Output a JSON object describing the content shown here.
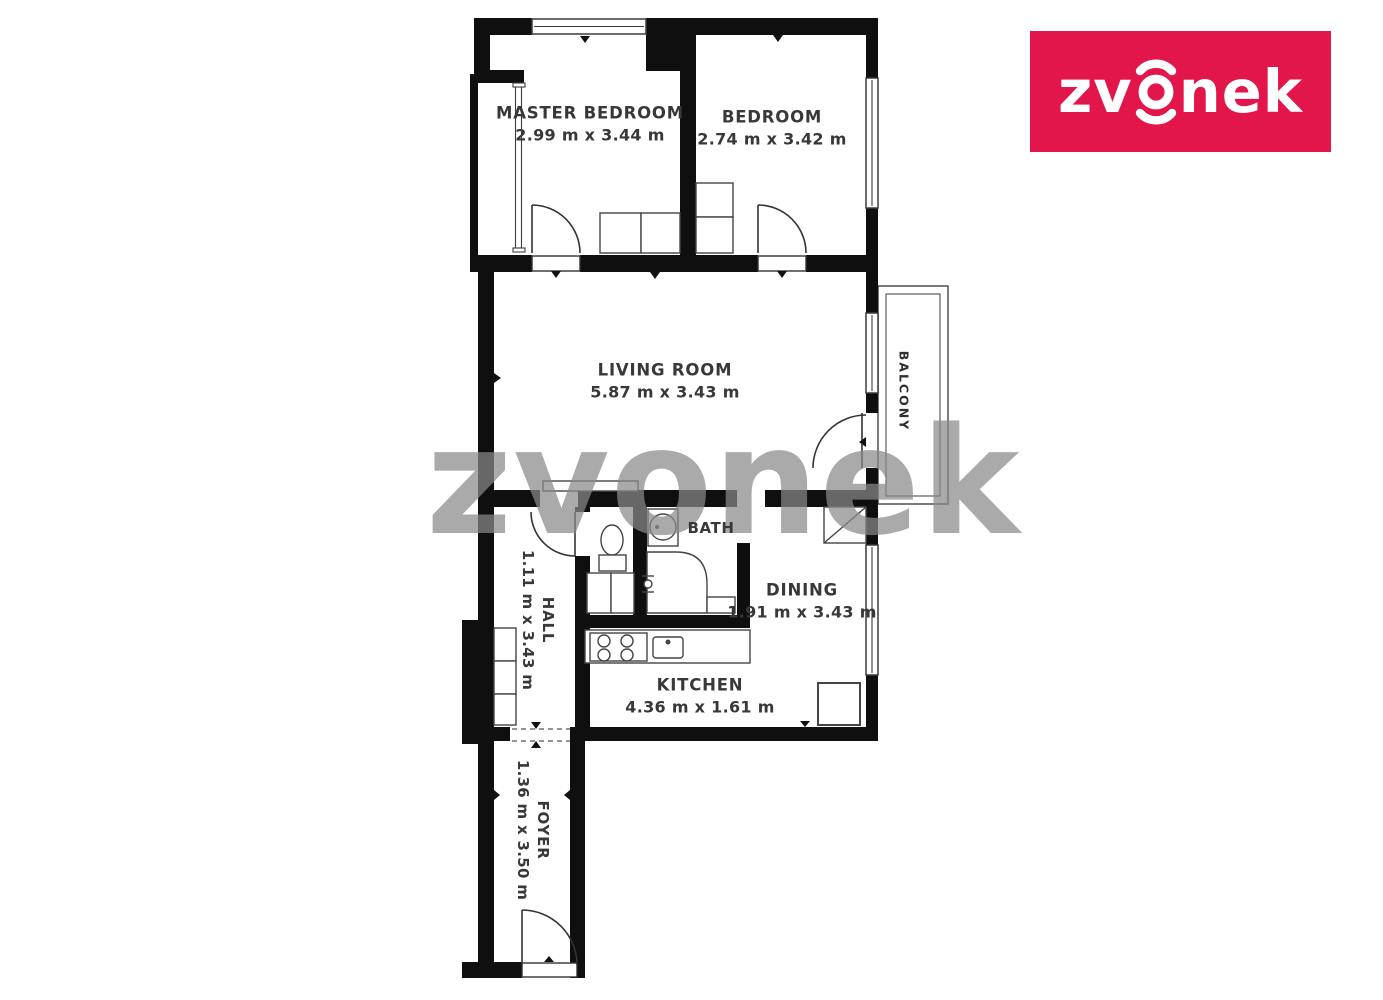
{
  "brand": {
    "text": "zvonek",
    "text_left": "zv",
    "text_right": "nek",
    "bg_color": "#e2164a",
    "fg_color": "#ffffff"
  },
  "watermark": {
    "text": "zvonek"
  },
  "rooms": {
    "master_bedroom": {
      "name": "MASTER BEDROOM",
      "dims": "2.99 m x 3.44 m"
    },
    "bedroom": {
      "name": "BEDROOM",
      "dims": "2.74 m x 3.42 m"
    },
    "living_room": {
      "name": "LIVING ROOM",
      "dims": "5.87 m x 3.43 m"
    },
    "bath": {
      "name": "BATH"
    },
    "dining": {
      "name": "DINING",
      "dims": "1.91 m x 3.43 m"
    },
    "kitchen": {
      "name": "KITCHEN",
      "dims": "4.36 m x 1.61 m"
    },
    "hall": {
      "name": "HALL",
      "dims": "1.11 m x 3.43 m"
    },
    "foyer": {
      "name": "FOYER",
      "dims": "1.36 m x 3.50 m"
    },
    "balcony": {
      "name": "BALCONY"
    }
  }
}
